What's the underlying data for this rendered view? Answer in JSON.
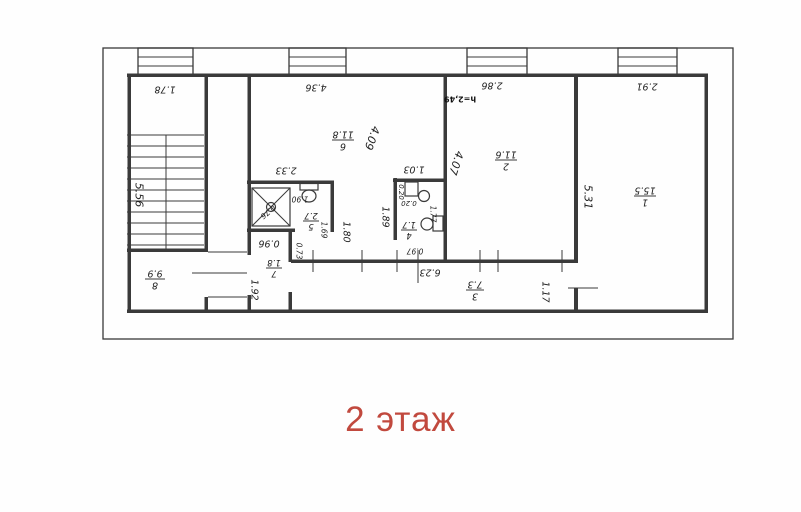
{
  "caption": {
    "text": "2 этаж",
    "color": "#c1493e"
  },
  "plan": {
    "line_color": "#3a3a3a",
    "note": "h=2,49",
    "rooms": {
      "r1": {
        "number": "1",
        "area": "15.5"
      },
      "r2": {
        "number": "2",
        "area": "11.6"
      },
      "r3": {
        "number": "3",
        "area": "7.3"
      },
      "r4": {
        "number": "4",
        "area": "1.7"
      },
      "r5": {
        "number": "5",
        "area": "2.7"
      },
      "r6": {
        "number": "6",
        "area": "11.8"
      },
      "r7": {
        "number": "7",
        "area": "1.8"
      },
      "r8": {
        "number": "8",
        "area": "9.9"
      }
    },
    "dims": {
      "stair_width": "1.78",
      "stair_length": "5.56",
      "room6_width": "4.36",
      "room6_depth": "4.09",
      "bath_width": "2.33",
      "shower": "0.76",
      "wc": "1.90",
      "bath_inner": "1.69",
      "bath_door": "0.73",
      "hall7_width": "0.96",
      "hall7_length": "1.92",
      "room4_width": "1.03",
      "room4_a": "0.20",
      "room4_b": "0.20",
      "room4_inner": "1.77",
      "room4_bottom": "0.97",
      "alcove_a": "1.80",
      "alcove_b": "1.89",
      "room2_width": "2.86",
      "room2_depth": "4.07",
      "room1_width": "2.91",
      "room1_depth": "5.31",
      "corridor_length": "6.23",
      "corridor_width": "1.17"
    }
  }
}
